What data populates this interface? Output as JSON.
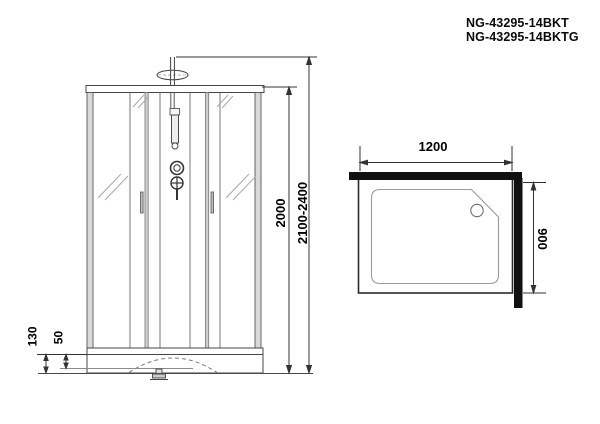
{
  "product_codes": {
    "line1": "NG-43295-14BKT",
    "line2": "NG-43295-14BKTG"
  },
  "front_view": {
    "label": "front-elevation-of-shower-cabin",
    "dimensions": {
      "cabin_height": "2000",
      "overall_height_range": "2100-2400",
      "tray_height": "130",
      "tray_inner_depth": "50"
    }
  },
  "plan_view": {
    "label": "top-plan-of-shower-tray",
    "dimensions": {
      "width": "1200",
      "depth": "900"
    }
  },
  "colors": {
    "background": "#ffffff",
    "line": "#3c3c3c",
    "glass_line": "#9a9a9a",
    "wall_fill": "#111111",
    "text": "#000000"
  }
}
